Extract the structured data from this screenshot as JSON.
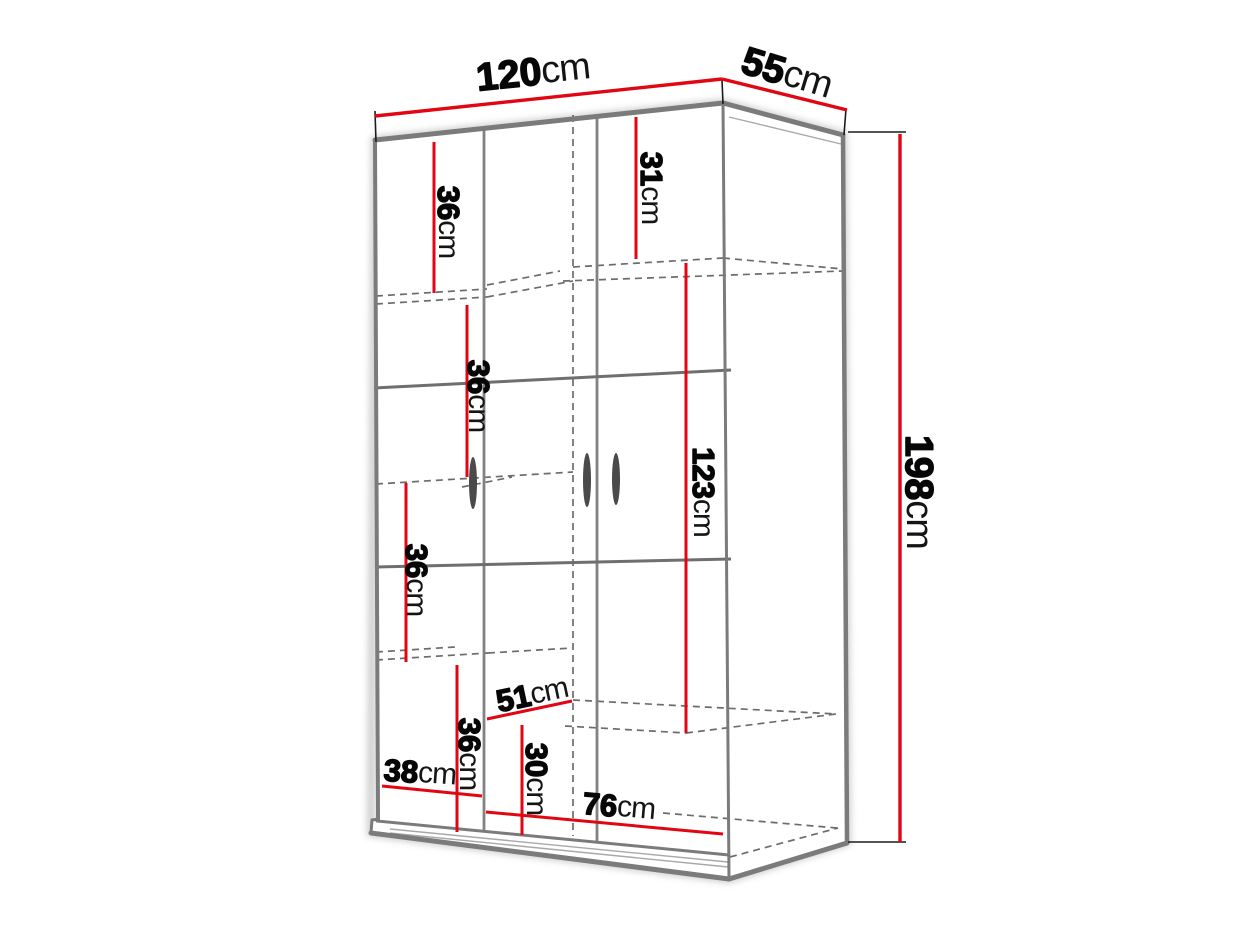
{
  "diagram": {
    "type": "furniture-dimension-diagram",
    "subject": "three-door wardrobe shown in perspective with internal shelf layout",
    "colors": {
      "dimension_line": "#e20613",
      "outline": "#7b7b7b",
      "hidden_edge": "#6c6c6c",
      "label_text": "#070707",
      "background": "#ffffff"
    },
    "dimensions": {
      "width": {
        "num": "120",
        "unit": "cm"
      },
      "depth": {
        "num": "55",
        "unit": "cm"
      },
      "height": {
        "num": "198",
        "unit": "cm"
      },
      "top_left_section_height": {
        "num": "36",
        "unit": "cm"
      },
      "top_right_section_height": {
        "num": "31",
        "unit": "cm"
      },
      "upper_left_shelf_gap": {
        "num": "36",
        "unit": "cm"
      },
      "hanging_section_height": {
        "num": "123",
        "unit": "cm"
      },
      "middle_left_shelf_gap": {
        "num": "36",
        "unit": "cm"
      },
      "lower_left_shelf_gap": {
        "num": "36",
        "unit": "cm"
      },
      "shelf_diagonal_depth": {
        "num": "51",
        "unit": "cm"
      },
      "bottom_right_section_height": {
        "num": "30",
        "unit": "cm"
      },
      "left_section_width": {
        "num": "38",
        "unit": "cm"
      },
      "right_section_width": {
        "num": "76",
        "unit": "cm"
      }
    }
  }
}
